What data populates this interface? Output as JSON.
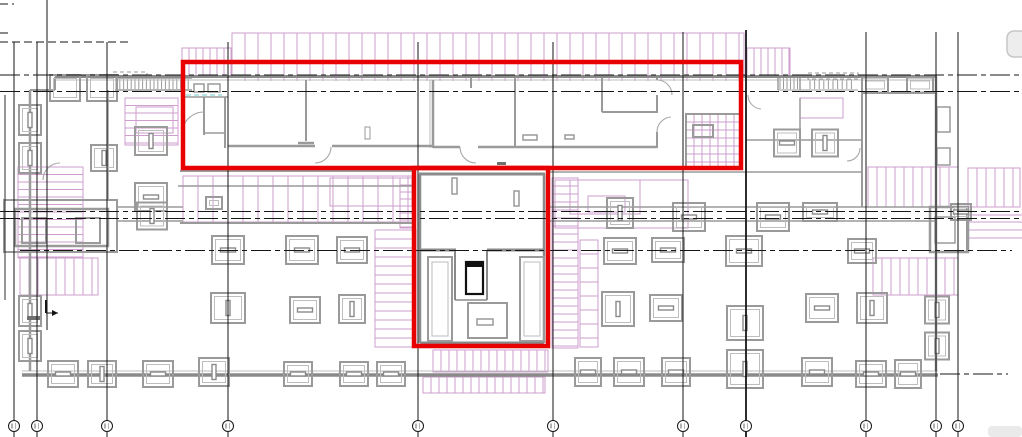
{
  "canvas": {
    "width": 1022,
    "height": 437,
    "background": "#ffffff",
    "kind": "cad-floor-plan"
  },
  "colors": {
    "red": "#e80000",
    "wall": "#9a9a9a",
    "wallDark": "#8a8a8a",
    "wallLight": "#bdbdbd",
    "purple": "#cf9ecf",
    "black": "#161616",
    "cyan": "#8ad6d6",
    "uiGray": "#ededed",
    "uiBorder": "#c6c6c6",
    "wash": "#eaeaea",
    "smudge": "#707070"
  },
  "red_highlights": [
    {
      "x": 183,
      "y": 62,
      "w": 558,
      "h": 106,
      "stroke": 4.5
    },
    {
      "x": 414,
      "y": 168,
      "w": 134,
      "h": 178,
      "stroke": 4.5
    }
  ],
  "grid": {
    "bubble_cy": 426,
    "bubble_r": 5.5,
    "verticals": [
      {
        "x": 5,
        "y1": 95,
        "y2": 300,
        "b": false,
        "w": 0.9
      },
      {
        "x": 14,
        "y1": 42,
        "y2": 437,
        "b": true,
        "w": 1
      },
      {
        "x": 37,
        "y1": 42,
        "y2": 437,
        "b": true,
        "w": 1
      },
      {
        "x": 47,
        "y1": 0,
        "y2": 330,
        "b": false,
        "w": 1
      },
      {
        "x": 107,
        "y1": 42,
        "y2": 437,
        "b": true,
        "w": 1
      },
      {
        "x": 228,
        "y1": 42,
        "y2": 437,
        "b": true,
        "w": 1
      },
      {
        "x": 418,
        "y1": 42,
        "y2": 437,
        "b": true,
        "w": 1
      },
      {
        "x": 553,
        "y1": 42,
        "y2": 437,
        "b": true,
        "w": 1
      },
      {
        "x": 683,
        "y1": 32,
        "y2": 437,
        "b": true,
        "w": 1
      },
      {
        "x": 746,
        "y1": 30,
        "y2": 437,
        "b": true,
        "w": 1.8
      },
      {
        "x": 866,
        "y1": 32,
        "y2": 437,
        "b": true,
        "w": 1
      },
      {
        "x": 936,
        "y1": 32,
        "y2": 437,
        "b": true,
        "w": 1
      },
      {
        "x": 958,
        "y1": 32,
        "y2": 437,
        "b": true,
        "w": 1
      }
    ],
    "h_dashdot": [
      [
        0,
        75,
        1022
      ],
      [
        0,
        91.5,
        1022
      ],
      [
        0,
        211.5,
        1022
      ],
      [
        0,
        218.5,
        1022
      ],
      [
        20,
        250.5,
        1012
      ],
      [
        940,
        374,
        1008
      ]
    ],
    "short_dashes": [
      [
        0,
        4,
        14
      ],
      [
        0,
        33,
        10
      ],
      [
        0,
        42,
        130
      ]
    ]
  },
  "hatches": [
    {
      "x": 182,
      "y": 48,
      "w": 50,
      "h": 28,
      "dir": "v",
      "step": 7
    },
    {
      "x": 232,
      "y": 33,
      "w": 512,
      "h": 43,
      "dir": "v",
      "step": 13
    },
    {
      "x": 232,
      "y": 76,
      "w": 512,
      "h": 5,
      "dir": "v",
      "step": 13,
      "border": false
    },
    {
      "x": 747,
      "y": 48,
      "w": 43,
      "h": 28,
      "dir": "v",
      "step": 7
    },
    {
      "x": 18,
      "y": 167,
      "w": 65,
      "h": 91,
      "dir": "h",
      "step": 7.5
    },
    {
      "x": 20,
      "y": 258,
      "w": 78,
      "h": 37,
      "dir": "v",
      "step": 9
    },
    {
      "x": 125,
      "y": 98,
      "w": 53,
      "h": 47,
      "dir": "h",
      "step": 7.5
    },
    {
      "x": 375,
      "y": 230,
      "w": 41,
      "h": 117,
      "dir": "h",
      "step": 9
    },
    {
      "x": 552,
      "y": 178,
      "w": 26,
      "h": 170,
      "dir": "h",
      "step": 8
    },
    {
      "x": 580,
      "y": 240,
      "w": 18,
      "h": 107,
      "dir": "h",
      "step": 14
    },
    {
      "x": 868,
      "y": 167,
      "w": 90,
      "h": 40,
      "dir": "v",
      "step": 9
    },
    {
      "x": 873,
      "y": 258,
      "w": 85,
      "h": 37,
      "dir": "v",
      "step": 9
    },
    {
      "x": 433,
      "y": 350,
      "w": 115,
      "h": 22,
      "dir": "v",
      "step": 8
    },
    {
      "x": 423,
      "y": 377,
      "w": 122,
      "h": 16,
      "dir": "v",
      "step": 8
    },
    {
      "x": 183,
      "y": 176,
      "w": 230,
      "h": 46,
      "dir": "v",
      "step": 15
    },
    {
      "x": 400,
      "y": 178,
      "w": 13,
      "h": 50,
      "dir": "h",
      "step": 7
    },
    {
      "x": 968,
      "y": 168,
      "w": 52,
      "h": 39,
      "dir": "v",
      "step": 9
    },
    {
      "x": 686,
      "y": 114,
      "w": 56,
      "h": 54,
      "dir": "c",
      "step": 8
    }
  ],
  "purple_rects": [
    [
      136,
      107,
      37,
      26
    ],
    [
      800,
      98,
      43,
      20
    ],
    [
      555,
      180,
      133,
      48
    ],
    [
      570,
      180,
      70,
      34
    ],
    [
      330,
      178,
      82,
      28
    ],
    [
      588,
      196,
      37,
      16
    ]
  ],
  "purple_lines": [
    [
      967,
      215,
      1022,
      215
    ],
    [
      967,
      222,
      1022,
      222
    ],
    [
      967,
      230,
      1022,
      230
    ],
    [
      967,
      238,
      1022,
      238
    ]
  ],
  "cyan_dashes": [
    [
      186,
      95,
      222,
      95
    ]
  ],
  "walls": [
    [
      30,
      90,
      30,
      371,
      2.5
    ],
    [
      30,
      90,
      55,
      90,
      2
    ],
    [
      55,
      77,
      55,
      90,
      2
    ],
    [
      936,
      77,
      936,
      371,
      2.5
    ],
    [
      180,
      171,
      415,
      171,
      2
    ],
    [
      548,
      172,
      862,
      172,
      1.5
    ],
    [
      178,
      186,
      415,
      186,
      1.5
    ],
    [
      180,
      223,
      413,
      223,
      2
    ],
    [
      117,
      207,
      183,
      207,
      1.5
    ],
    [
      117,
      221,
      183,
      221,
      1.5
    ],
    [
      548,
      207,
      936,
      207,
      1.5
    ],
    [
      548,
      221,
      936,
      221,
      1.5
    ],
    [
      183,
      97,
      228,
      97,
      1.5
    ],
    [
      204,
      97,
      204,
      135,
      2
    ],
    [
      204,
      133,
      225,
      133,
      1.5
    ],
    [
      225,
      97,
      225,
      148,
      2
    ],
    [
      306,
      80,
      306,
      141,
      2
    ],
    [
      298,
      143,
      314,
      143,
      2.5
    ],
    [
      228,
      146,
      315,
      146,
      2.5
    ],
    [
      332,
      146,
      433,
      146,
      2.5
    ],
    [
      433,
      80,
      433,
      148,
      2.5
    ],
    [
      471,
      77,
      471,
      88,
      2
    ],
    [
      515,
      77,
      515,
      148,
      2
    ],
    [
      433,
      147,
      460,
      147,
      2.5
    ],
    [
      478,
      147,
      657,
      147,
      2.5
    ],
    [
      602,
      78,
      602,
      112,
      2
    ],
    [
      602,
      112,
      657,
      112,
      2
    ],
    [
      657,
      77,
      657,
      80,
      2
    ],
    [
      657,
      95,
      657,
      113,
      2
    ],
    [
      657,
      132,
      657,
      148,
      2
    ],
    [
      862,
      93,
      862,
      207,
      2
    ],
    [
      862,
      93,
      936,
      93,
      2
    ],
    [
      746,
      140,
      862,
      140,
      1.5
    ],
    [
      800,
      98,
      800,
      140,
      1.5
    ],
    [
      108,
      90,
      108,
      200,
      1.5
    ],
    [
      115,
      78,
      192,
      78,
      1.5
    ],
    [
      115,
      90,
      192,
      90,
      1.5
    ],
    [
      778,
      75,
      778,
      90,
      1.5
    ],
    [
      800,
      75,
      800,
      90,
      1.5
    ],
    [
      778,
      90,
      858,
      90,
      1
    ],
    [
      967,
      207,
      967,
      252,
      2
    ]
  ],
  "walls_top": [
    [
      55,
      76.5,
      937,
      76.5,
      3
    ],
    [
      22,
      375,
      938,
      375,
      3.5
    ]
  ],
  "walls_light": [
    [
      55,
      80,
      937,
      80,
      1
    ],
    [
      22,
      371,
      938,
      371,
      1
    ],
    [
      430,
      80,
      430,
      148,
      1
    ]
  ],
  "core_walls": [
    [
      419,
      174,
      545,
      174,
      3
    ],
    [
      420,
      174,
      420,
      250,
      2.5
    ],
    [
      544,
      174,
      544,
      250,
      2.5
    ],
    [
      419,
      250,
      456,
      250,
      3
    ],
    [
      487,
      250,
      545,
      250,
      3
    ],
    [
      420,
      250,
      420,
      343,
      2.5
    ],
    [
      544,
      250,
      544,
      343,
      2.5
    ],
    [
      420,
      343,
      544,
      343,
      3
    ],
    [
      455,
      250,
      455,
      300,
      2
    ],
    [
      487,
      250,
      487,
      300,
      2
    ],
    [
      455,
      300,
      487,
      300,
      1.5
    ]
  ],
  "gray_rects": [
    [
      4,
      200,
      113,
      52,
      2
    ],
    [
      15,
      209,
      93,
      37,
      2.5
    ],
    [
      22,
      218,
      24,
      25,
      2
    ],
    [
      76,
      218,
      24,
      25,
      2
    ],
    [
      930,
      207,
      38,
      45,
      2.5
    ],
    [
      935,
      217,
      20,
      26,
      1.5
    ],
    [
      937,
      107,
      13,
      25,
      1.5
    ],
    [
      937,
      148,
      13,
      17,
      1.5
    ],
    [
      686,
      114,
      56,
      54,
      2
    ],
    [
      693,
      125,
      20,
      12,
      2
    ],
    [
      428,
      257,
      24,
      84,
      2
    ],
    [
      520,
      257,
      24,
      84,
      2
    ],
    [
      468,
      303,
      39,
      35,
      2
    ],
    [
      477,
      319,
      16,
      6,
      1.5
    ],
    [
      452,
      178,
      5,
      16,
      1.5
    ],
    [
      514,
      191,
      5,
      15,
      1.5
    ],
    [
      365,
      127,
      5,
      12,
      1
    ],
    [
      194,
      84,
      10,
      8,
      1.5
    ],
    [
      208,
      84,
      12,
      8,
      1.5
    ],
    [
      523,
      135,
      14,
      5,
      1.5
    ],
    [
      565,
      135,
      9,
      4,
      1.5
    ]
  ],
  "light_rects": [
    [
      432,
      262,
      16,
      74,
      1
    ],
    [
      524,
      262,
      16,
      74,
      1
    ]
  ],
  "black_fills": [
    [
      466,
      262,
      17,
      5
    ]
  ],
  "black_rects": [
    [
      466,
      262,
      17,
      32,
      2.2
    ]
  ],
  "stairs": [
    {
      "x": 116,
      "y": 79,
      "w": 75,
      "h": 10,
      "step": 3.8
    },
    {
      "x": 780,
      "y": 76,
      "w": 20,
      "h": 13,
      "step": 3.5
    },
    {
      "x": 810,
      "y": 79,
      "w": 46,
      "h": 10,
      "step": 4.6
    }
  ],
  "dashed_rects": [
    [
      113,
      72,
      34,
      8
    ],
    [
      808,
      73,
      50,
      6
    ]
  ],
  "columns": [
    [
      65,
      88,
      "p",
      30,
      26
    ],
    [
      102,
      88,
      "p",
      30,
      26
    ],
    [
      875,
      85,
      "p",
      26,
      15
    ],
    [
      920,
      85,
      "p",
      26,
      15
    ],
    [
      30,
      120,
      "v",
      22,
      30
    ],
    [
      30,
      158,
      "v",
      22,
      30
    ],
    [
      30,
      311,
      "v",
      22,
      30
    ],
    [
      30,
      346,
      "v",
      22,
      30
    ],
    [
      151,
      141,
      "v",
      32,
      28
    ],
    [
      104,
      158,
      "v",
      26,
      26
    ],
    [
      151,
      197,
      "h",
      32,
      28
    ],
    [
      214,
      203,
      "p",
      16,
      12
    ],
    [
      152,
      216,
      "v",
      30,
      27
    ],
    [
      620,
      213,
      "v",
      26,
      30
    ],
    [
      689,
      217,
      "h",
      32,
      28
    ],
    [
      773,
      217,
      "h",
      32,
      28
    ],
    [
      820,
      212,
      "h",
      34,
      18
    ],
    [
      961,
      212,
      "h",
      20,
      16
    ],
    [
      228,
      250,
      "h",
      32,
      28
    ],
    [
      302,
      250,
      "h",
      32,
      28
    ],
    [
      352,
      250,
      "h",
      30,
      26
    ],
    [
      620,
      251,
      "h",
      32,
      26
    ],
    [
      668,
      250,
      "h",
      32,
      24
    ],
    [
      744,
      251,
      "h",
      36,
      30
    ],
    [
      862,
      251,
      "h",
      28,
      24
    ],
    [
      228,
      308,
      "v",
      34,
      30
    ],
    [
      305,
      310,
      "h",
      30,
      26
    ],
    [
      352,
      309,
      "v",
      26,
      28
    ],
    [
      618,
      309,
      "v",
      32,
      34
    ],
    [
      666,
      308,
      "h",
      32,
      26
    ],
    [
      745,
      323,
      "v",
      36,
      34
    ],
    [
      822,
      308,
      "h",
      32,
      28
    ],
    [
      872,
      308,
      "v",
      30,
      30
    ],
    [
      937,
      310,
      "v",
      24,
      27
    ],
    [
      937,
      346,
      "v",
      24,
      27
    ],
    [
      787,
      143,
      "h",
      26,
      27
    ],
    [
      825,
      143,
      "v",
      26,
      27
    ],
    [
      63,
      374,
      "h",
      30,
      26
    ],
    [
      102,
      374,
      "v",
      28,
      26
    ],
    [
      158,
      374,
      "h",
      30,
      26
    ],
    [
      214,
      372,
      "v",
      30,
      28
    ],
    [
      298,
      374,
      "h",
      28,
      24
    ],
    [
      354,
      374,
      "h",
      28,
      24
    ],
    [
      391,
      374,
      "h",
      28,
      24
    ],
    [
      588,
      372,
      "h",
      26,
      28
    ],
    [
      629,
      372,
      "h",
      30,
      28
    ],
    [
      676,
      372,
      "h",
      28,
      28
    ],
    [
      745,
      369,
      "v",
      36,
      38
    ],
    [
      817,
      372,
      "h",
      30,
      28
    ],
    [
      871,
      374,
      "h",
      30,
      26
    ],
    [
      908,
      374,
      "h",
      26,
      28
    ]
  ],
  "doors": [
    "M 204 112 A 22 22 0 0 0 182 134",
    "M 331 147 A 16 16 0 0 1 315 163",
    "M 460 147 A 16 16 0 0 0 476 163",
    "M 657 80 A 15 15 0 0 1 672 95",
    "M 657 132 A 15 15 0 0 1 671 117",
    "M 748 95 A 14 14 0 0 0 761 109",
    "M 860 148 A 13 13 0 0 1 847 161",
    "M 43 180 A 17 17 0 0 1 60 163"
  ],
  "marker": {
    "v": [
      46,
      300,
      46,
      313
    ],
    "h": [
      46,
      313,
      58,
      313
    ],
    "head": [
      [
        58,
        313
      ],
      [
        52,
        310
      ],
      [
        52,
        316
      ]
    ]
  },
  "smudges": [
    [
      27,
      316,
      13,
      4
    ],
    [
      497,
      162,
      9,
      3
    ]
  ],
  "ui": {
    "top_right_fragment": {
      "x": 1007,
      "y": 31,
      "w": 26,
      "h": 26,
      "r": 7
    },
    "corner_wash": {
      "x": 988,
      "y": 426,
      "w": 34,
      "h": 11
    }
  }
}
